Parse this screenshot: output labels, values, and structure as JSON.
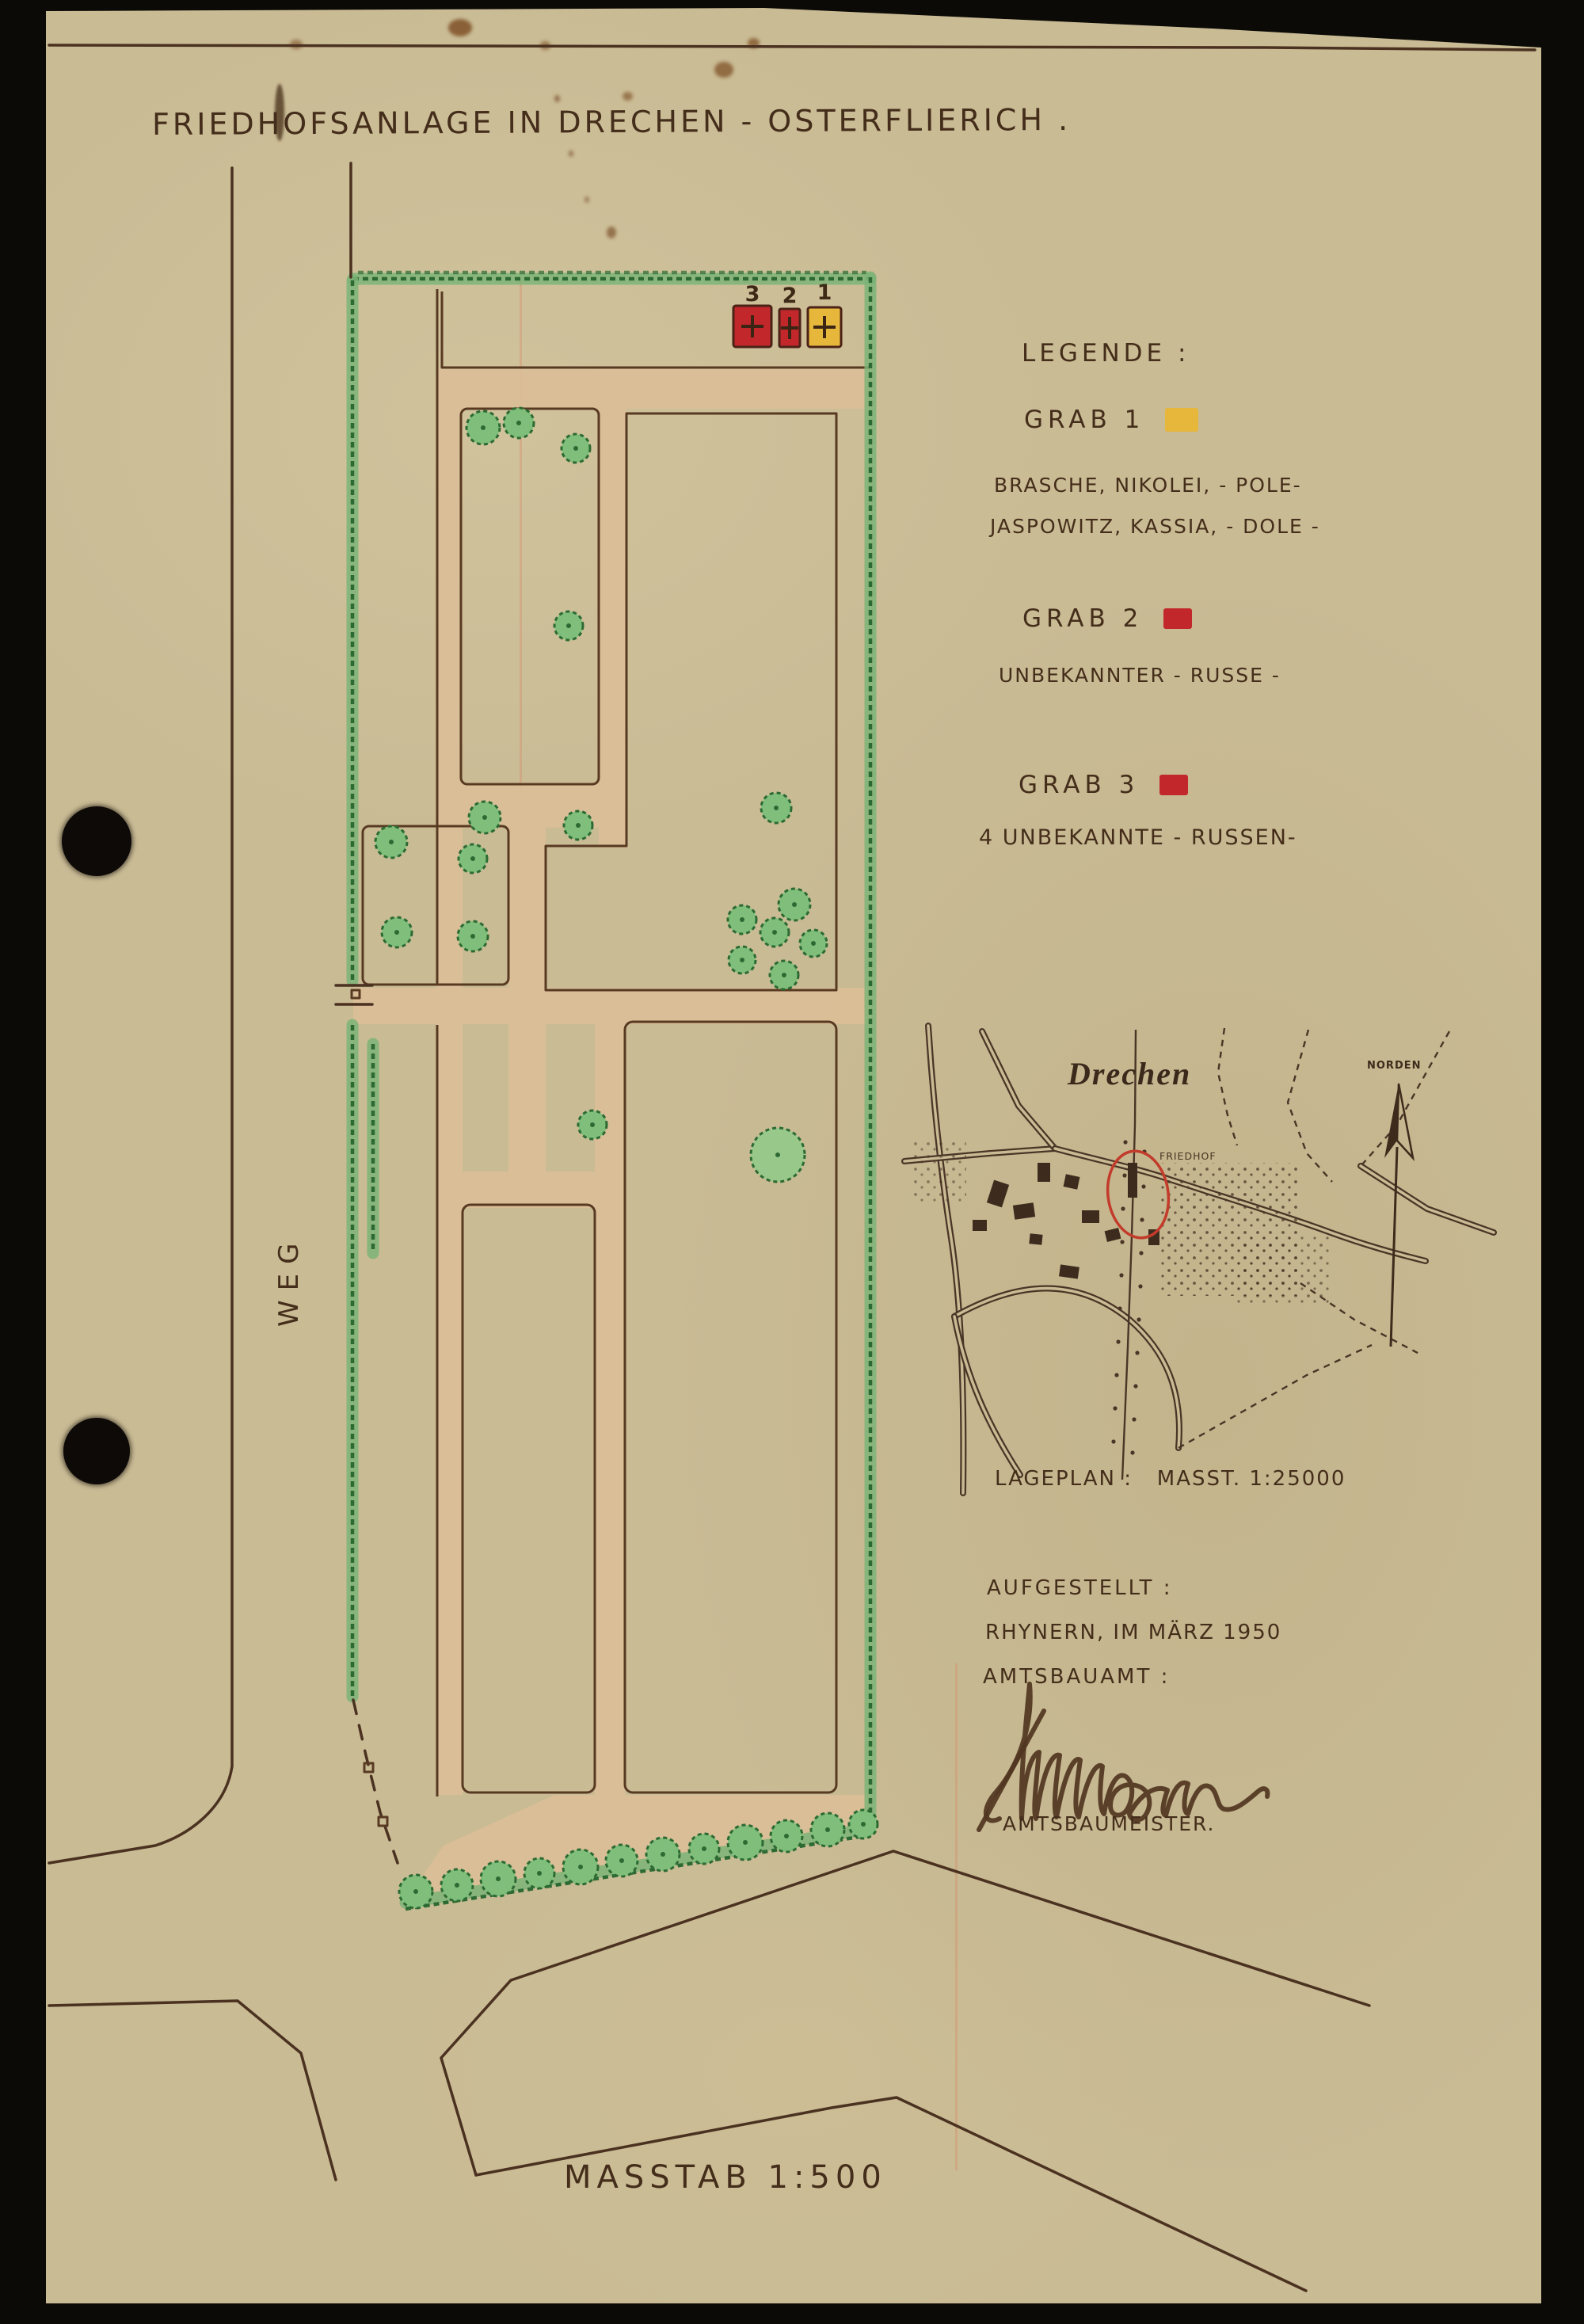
{
  "page": {
    "title": "FRIEDHOFSANLAGE IN DRECHEN - OSTERFLIERICH ."
  },
  "legend": {
    "heading": "LEGENDE :",
    "entries": [
      {
        "label": "GRAB 1",
        "swatch_color": "#e7b73c",
        "lines": [
          "BRASCHE, NIKOLEI, - POLE-",
          "JASPOWITZ, KASSIA, - DOLE -"
        ]
      },
      {
        "label": "GRAB 2",
        "swatch_color": "#c2282b",
        "lines": [
          "UNBEKANNTER - RUSSE -"
        ]
      },
      {
        "label": "GRAB 3",
        "swatch_color": "#c2282b",
        "lines": [
          "4 UNBEKANNTE - RUSSEN-"
        ]
      }
    ]
  },
  "site_plan": {
    "road_label": "WEG",
    "scale_label": "MASSTAB 1:500",
    "graves": [
      {
        "number": "3",
        "color": "#c2282b"
      },
      {
        "number": "2",
        "color": "#c2282b"
      },
      {
        "number": "1",
        "color": "#e7b73c"
      }
    ]
  },
  "location_map": {
    "town_label": "Drechen",
    "cemetery_label": "FRIEDHOF",
    "north_label": "NORDEN",
    "caption": "LAGEPLAN :   MASST. 1:25000"
  },
  "attribution": {
    "heading": "AUFGESTELLT :",
    "place_date": "RHYNERN, IM MÄRZ 1950",
    "office": "AMTSBAUAMT :",
    "signature_name": "Schneider",
    "role": "AMTSBAUMEISTER."
  },
  "colors": {
    "paper": "#c9bb94",
    "ink": "#442d1a",
    "plan_outline": "#583a22",
    "path_fill": "#dabe97",
    "hedge_green": "#2d6a33",
    "tree_green": "#80bf7b",
    "grave_red": "#c2282b",
    "grave_yellow": "#e7b73c",
    "highlight_circle_red": "#c23b2b"
  }
}
